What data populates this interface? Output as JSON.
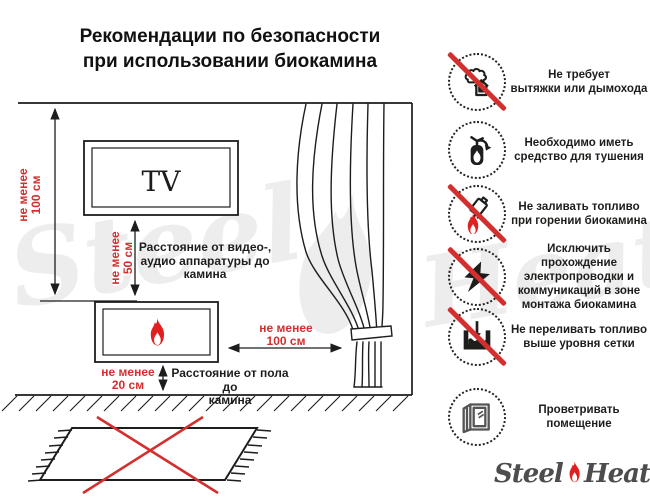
{
  "title": "Рекомендации по безопасности\nпри использовании биокамина",
  "diagram": {
    "tv_label": "TV",
    "ceiling_clearance": "не менее\n100 см",
    "tv_clearance": "не менее\n50 см",
    "tv_clearance_caption": "Расстояние от видео-,\nаудио аппаратуры до\nкамина",
    "curtain_clearance": "не менее\n100 см",
    "floor_clearance": "не менее\n20 см",
    "floor_clearance_caption": "Расстояние от пола до\nкамина"
  },
  "rules": [
    {
      "name": "no-chimney",
      "crossed": true,
      "text": "Не требует\nвытяжки или дымохода"
    },
    {
      "name": "extinguisher-required",
      "crossed": false,
      "text": "Необходимо иметь\nсредство для тушения"
    },
    {
      "name": "no-refuel-while-burning",
      "crossed": true,
      "text": "Не заливать топливо\nпри горении биокамина"
    },
    {
      "name": "no-wiring-in-zone",
      "crossed": true,
      "text": "Исключить прохождение\nэлектропроводки и\nкоммуникаций в зоне\nмонтажа биокамина"
    },
    {
      "name": "no-overfill",
      "crossed": true,
      "text": "Не переливать топливо\nвыше уровня сетки"
    },
    {
      "name": "ventilate-room",
      "crossed": false,
      "text": "Проветривать\nпомещение"
    }
  ],
  "logo": {
    "steel": "Steel",
    "heat": "Heat"
  },
  "colors": {
    "accent_red": "#d32f2f",
    "ink": "#1d1d1b",
    "watermark": "#ededed"
  }
}
